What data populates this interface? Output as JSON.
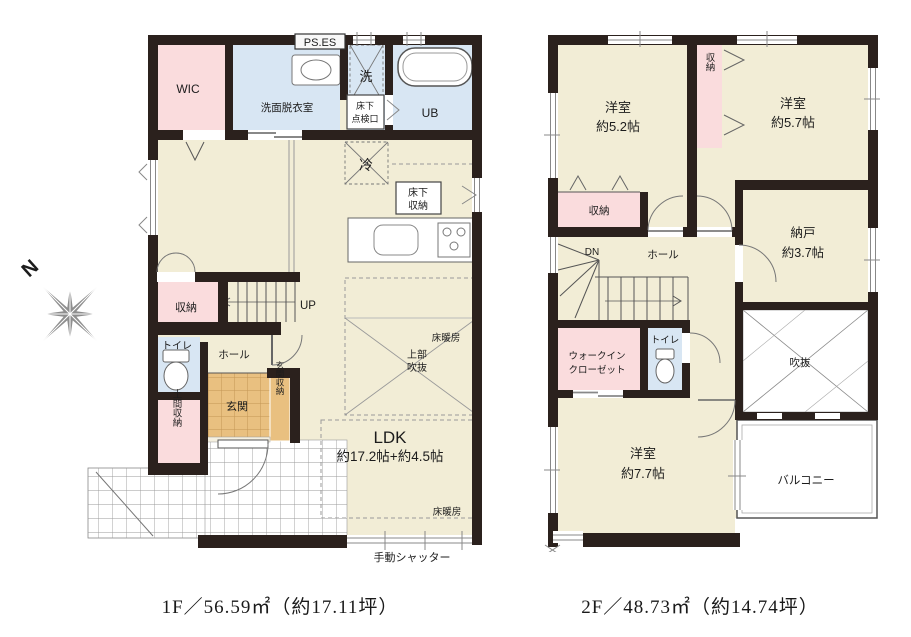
{
  "colors": {
    "wall": "#2b211d",
    "room_beige": "#f2edd6",
    "room_pink": "#fadcdd",
    "room_blue": "#d8e6f3",
    "genkan_tan": "#e9c080",
    "compass_gray": "#8e8e8e"
  },
  "compass": {
    "north_label": "N"
  },
  "floor1": {
    "caption": "1F／56.59㎡（約17.11坪）",
    "labels": {
      "wic": "WIC",
      "ps_es": "PS.ES",
      "senmen": "洗面脱衣室",
      "sentaku": "洗",
      "ub": "UB",
      "tenkenko_line1": "床下",
      "tenkenko_line2": "点検口",
      "reizoko": "冷",
      "yukashita_shuno_line1": "床下",
      "yukashita_shuno_line2": "収納",
      "shuno": "収納",
      "up": "UP",
      "toilet": "トイレ",
      "hall": "ホール",
      "genkan": "玄関",
      "genkan_shuno": "玄関収納",
      "doma_shuno": "土間収納",
      "jobu_fukinuke_line1": "上部",
      "jobu_fukinuke_line2": "吹抜",
      "ldk": "LDK",
      "ldk_size": "約17.2帖+約4.5帖",
      "yukadanbo_upper": "床暖房",
      "yukadanbo_lower": "床暖房",
      "shutter": "手動シャッター"
    }
  },
  "floor2": {
    "caption": "2F／48.73㎡（約14.74坪）",
    "labels": {
      "yoshitsu52_line1": "洋室",
      "yoshitsu52_line2": "約5.2帖",
      "shuno_top": "収納",
      "yoshitsu57_line1": "洋室",
      "yoshitsu57_line2": "約5.7帖",
      "shuno_left": "収納",
      "nando_line1": "納戸",
      "nando_line2": "約3.7帖",
      "dn": "DN",
      "hall": "ホール",
      "wic_line1": "ウォークイン",
      "wic_line2": "クローゼット",
      "toilet": "トイレ",
      "fukinuke": "吹抜",
      "yoshitsu77_line1": "洋室",
      "yoshitsu77_line2": "約7.7帖",
      "balcony": "バルコニー"
    }
  }
}
